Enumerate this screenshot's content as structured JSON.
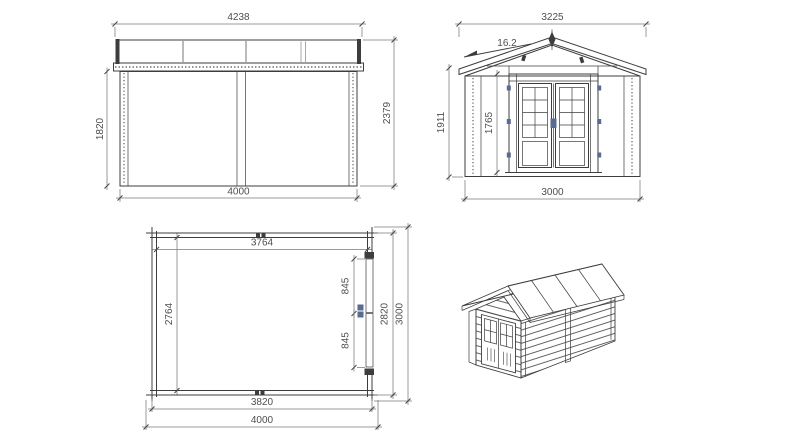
{
  "page": {
    "title": "Log cabin garden house technical drawing"
  },
  "colors": {
    "line": "#3d3d3d",
    "dimension_line": "#7a7a7a",
    "text": "#4f4f4f",
    "hardware_accent": "#5a6b8f",
    "door_hatch": "#7b6c5a",
    "background": "#ffffff"
  },
  "views": {
    "side_elevation": {
      "label": "side-elevation",
      "dimensions": {
        "roof_width": "4238",
        "wall_height": "1820",
        "total_height": "2379",
        "base_width": "4000"
      }
    },
    "front_elevation": {
      "label": "front-elevation",
      "dimensions": {
        "roof_width": "3225",
        "roof_pitch": "16.2",
        "eave_height": "1911",
        "door_height": "1765",
        "base_width": "3000"
      }
    },
    "floor_plan": {
      "label": "floor-plan",
      "dimensions": {
        "inner_width": "3764",
        "inner_depth": "2764",
        "door_leaf_upper": "845",
        "door_leaf_lower": "845",
        "wall_depth": "2820",
        "overall_depth": "3000",
        "wall_width": "3820",
        "overall_width": "4000"
      }
    },
    "perspective": {
      "label": "3d-view"
    }
  }
}
